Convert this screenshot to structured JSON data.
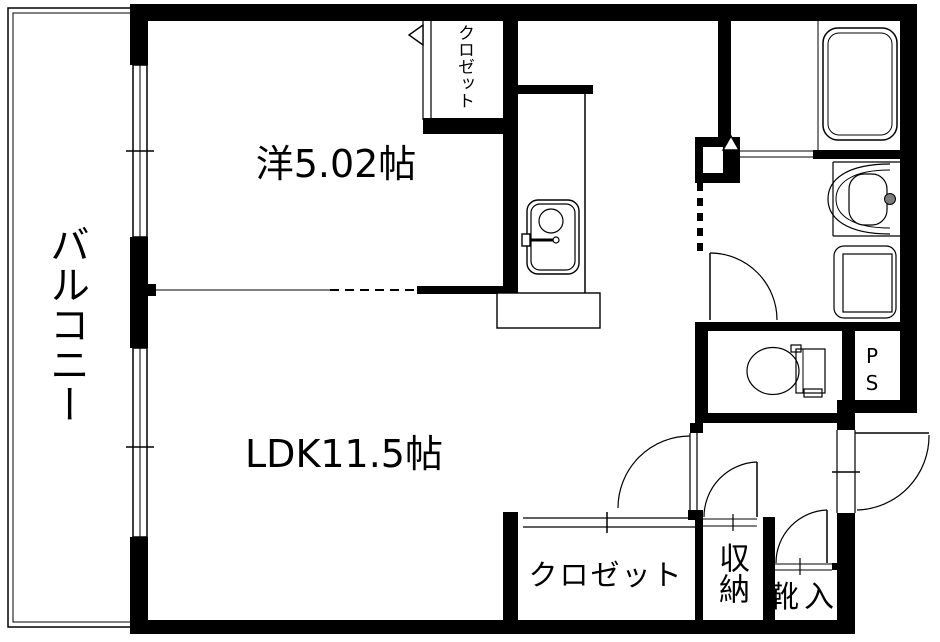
{
  "floor_plan": {
    "type": "apartment-floor-plan",
    "labels": {
      "balcony": "バルコニー",
      "western_room": "洋5.02帖",
      "ldk": "LDK11.5帖",
      "closet_top": "クロゼット",
      "closet_bottom": "クロゼット",
      "storage": "収納",
      "shoe_cabinet": "靴入",
      "pipe_space": "PS"
    },
    "colors": {
      "wall": "#000000",
      "floor": "#ffffff",
      "faucet_knob": "#7d7d7d"
    }
  }
}
